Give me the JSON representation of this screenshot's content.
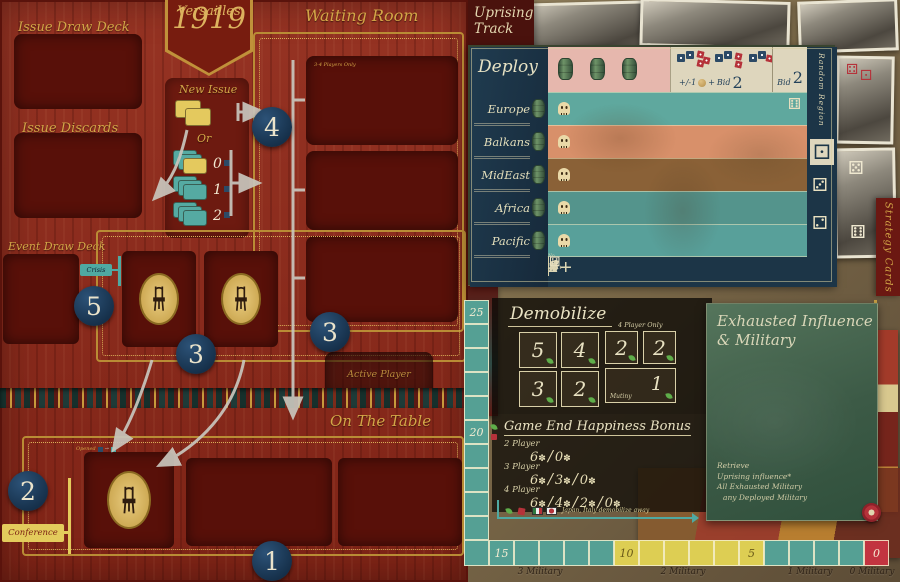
{
  "colors": {
    "board_red": "#8e2b1d",
    "gold": "#d3a647",
    "step_circle_navy": "#1d3a57",
    "track_teal": "#55a094",
    "track_yellow": "#ddce53",
    "track_red": "#c23440",
    "table_navy": "#1c3547",
    "exhausted_green": "#466850"
  },
  "left_board": {
    "title_word": "Versailles",
    "title_year": "1919",
    "issue_draw_deck_label": "Issue Draw Deck",
    "issue_discards_label": "Issue Discards",
    "new_issue": {
      "title": "New Issue",
      "or_label": "Or",
      "stack_counts": [
        "0",
        "1",
        "2"
      ]
    },
    "waiting_room": {
      "title": "Waiting Room",
      "slot_note": "3-4 Players Only"
    },
    "event_draw_deck_label": "Event Draw Deck",
    "crisis_tag": "Crisis",
    "active_player_label": "Active Player",
    "on_the_table_title": "On The Table",
    "conference_tag": "Conference",
    "opened_label": "Opened",
    "steps": {
      "s1": "1",
      "s2": "2",
      "s3": "3",
      "s4": "4",
      "s5": "5"
    }
  },
  "uprising": {
    "line1": "Uprising",
    "line2": "Track"
  },
  "deploy": {
    "title": "Deploy",
    "regions": [
      "Europe",
      "Balkans",
      "MidEast",
      "Africa",
      "Pacific"
    ],
    "plus_minus": "+/-1",
    "plus": "+",
    "bid_word": "Bid",
    "bid_value": "2",
    "bid_right_word": "Bid",
    "bid_right_value": "2",
    "random_region_label": "Random Region",
    "result_row": [
      "x",
      "x",
      "6+",
      "5+",
      "4+",
      "3+",
      "2+",
      "1+"
    ],
    "no_effect_label": "No Effect"
  },
  "strategy_cards_label": "Strategy Cards",
  "demobilize": {
    "title": "Demobilize",
    "values_main": [
      "5",
      "4",
      "3",
      "2"
    ],
    "four_player_note": "4 Player Only",
    "values_four_player": [
      "2",
      "2"
    ],
    "mutiny_label": "Mutiny",
    "mutiny_value": "1"
  },
  "happiness": {
    "title": "Game End Happiness Bonus",
    "rows": [
      {
        "label": "2 Player",
        "values": [
          "6",
          "0"
        ]
      },
      {
        "label": "3 Player",
        "values": [
          "6",
          "3",
          "0"
        ]
      },
      {
        "label": "4 Player",
        "values": [
          "6",
          "4",
          "2",
          "0"
        ]
      }
    ]
  },
  "exhausted": {
    "title_line1": "Exhausted Influence",
    "title_line2": "& Military",
    "notes": [
      "Retrieve",
      "Uprising influence*",
      "All Exhausted Military",
      "any Deployed Military"
    ]
  },
  "score_track": {
    "v25": "25",
    "v20": "20",
    "v15": "15",
    "v10": "10",
    "v5": "5",
    "v0": "0",
    "military_labels": [
      "3 Military",
      "2 Military",
      "1 Military",
      "0 Military"
    ],
    "demob_arrow_note": "Japan, Italy demobilize away"
  }
}
